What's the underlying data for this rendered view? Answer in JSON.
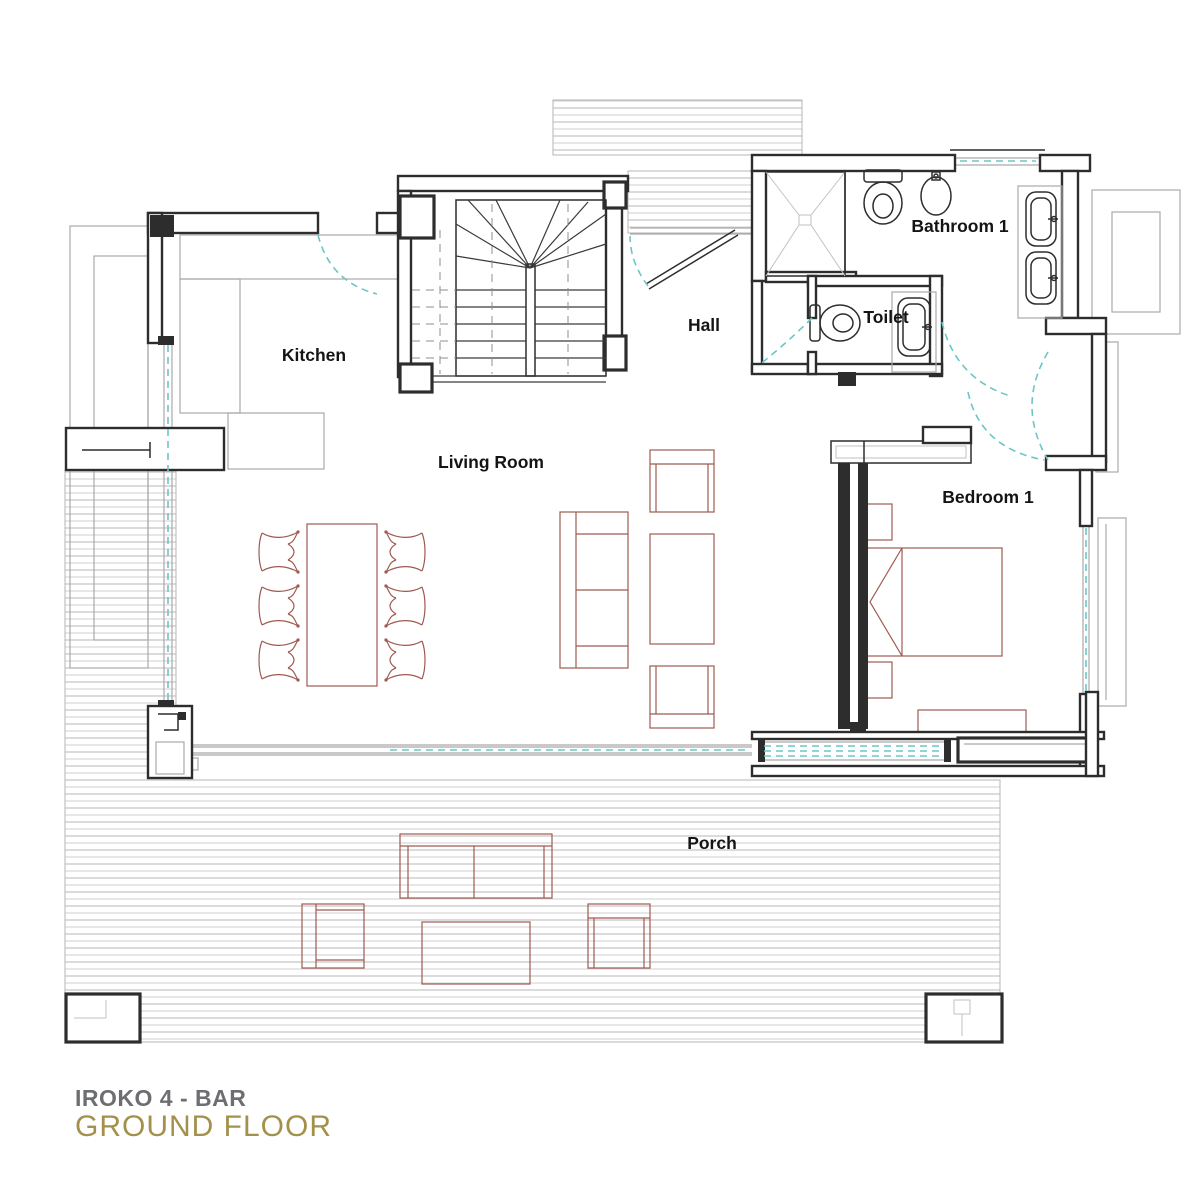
{
  "title": {
    "project": "IROKO 4 - BAR",
    "floor": "GROUND FLOOR"
  },
  "rooms": {
    "kitchen": {
      "label": "Kitchen"
    },
    "living_room": {
      "label": "Living Room"
    },
    "hall": {
      "label": "Hall"
    },
    "bathroom_1": {
      "label": "Bathroom 1"
    },
    "toilet": {
      "label": "Toilet"
    },
    "bedroom_1": {
      "label": "Bedroom 1"
    },
    "porch": {
      "label": "Porch"
    }
  },
  "symbols": [
    "staircase",
    "shower",
    "wc",
    "bidet",
    "washbasin",
    "double-sink-vanity",
    "bed",
    "nightstand",
    "wardrobe",
    "dining-table",
    "dining-chair",
    "sofa",
    "armchair",
    "coffee-table",
    "fireplace",
    "deck-post",
    "door-swing",
    "sliding-glass-door",
    "window",
    "deck-boards"
  ],
  "colors": {
    "wall": "#2d2d2d",
    "furniture_outline": "#9e5a50",
    "door_swing": "#6cc6c6",
    "deck_line": "#c2c2c2",
    "counter_outline": "#a9a9a9",
    "label_text": "#141414",
    "title_primary": "#6d6e71",
    "title_accent": "#a3914b"
  }
}
